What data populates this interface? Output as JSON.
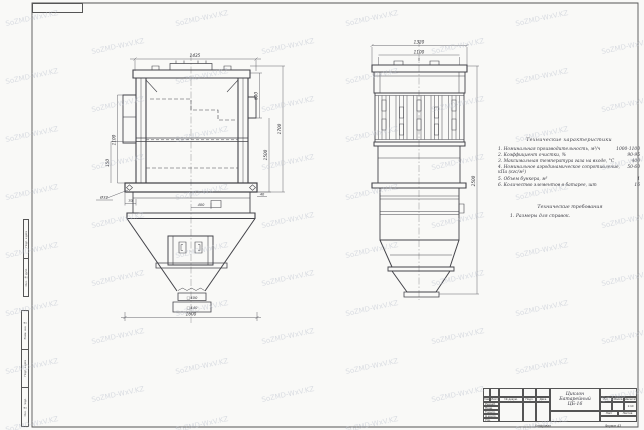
{
  "watermark": {
    "text": "SoZMD-WxV.KZ"
  },
  "front_view": {
    "dim_width_top": "1435",
    "dim_width_bottom": "1600",
    "dim_height_inlet": "600",
    "dim_height_body": "1500",
    "dim_height_overall": "1700",
    "dim_left_height": "1100",
    "dim_left_lower": "150",
    "dim_base_right": "40",
    "hole_callout": "Ø32",
    "dim_base_offset": "70",
    "dim_outlet_offset": "400",
    "outlet_square": "□400",
    "flange_square": "□440"
  },
  "side_view": {
    "dim_width_top": "1320",
    "dim_width_inner": "1100",
    "dim_height_overall": "2500"
  },
  "notes": {
    "title": "Технические характеристики",
    "items": [
      {
        "label": "1. Номинальная производительность, м³/ч",
        "value": "1000-1100"
      },
      {
        "label": "2. Коэффициент очистки, %",
        "value": "90-95"
      },
      {
        "label": "3. Максимальная температура газа на входе, °C",
        "value": "400"
      },
      {
        "label": "4. Номинальное аэродинамическое сопротивление, кПа (кгс/м²)",
        "value": "50-60"
      },
      {
        "label": "5. Объем бункера, м³",
        "value": "1"
      },
      {
        "label": "6. Количество элементов в батарее, шт",
        "value": "16"
      }
    ],
    "req_title": "Технические требования",
    "req_item": "1. Размеры для справок."
  },
  "title_block": {
    "name_line1": "Циклон",
    "name_line2": "Батарейный",
    "name_line3": "ЦБ-16",
    "col_izm": "Изм.",
    "col_list": "Лист",
    "col_doc": "№ докум.",
    "col_podp": "Подп.",
    "col_data": "Дата",
    "row_razrab": "Разраб.",
    "row_prov": "Пров.",
    "row_tkontr": "Т.контр.",
    "row_nkontr": "Н.контр.",
    "row_utv": "Утв.",
    "lit_label": "Лит.",
    "mass_label": "Масса",
    "scale_label": "Масштаб",
    "scale_value": "1:10",
    "sheet_label": "Лист",
    "sheets_label": "Листов",
    "sheets_value": "1",
    "copied": "Копировал",
    "format": "Формат A3"
  },
  "margin_stamps": {
    "s1a": "Подп. и дата",
    "s1b": "Инв. № дубл.",
    "s2a": "Взам. инв. №",
    "s2b": "Подп. и дата",
    "s2c": "Инв. № подл."
  }
}
